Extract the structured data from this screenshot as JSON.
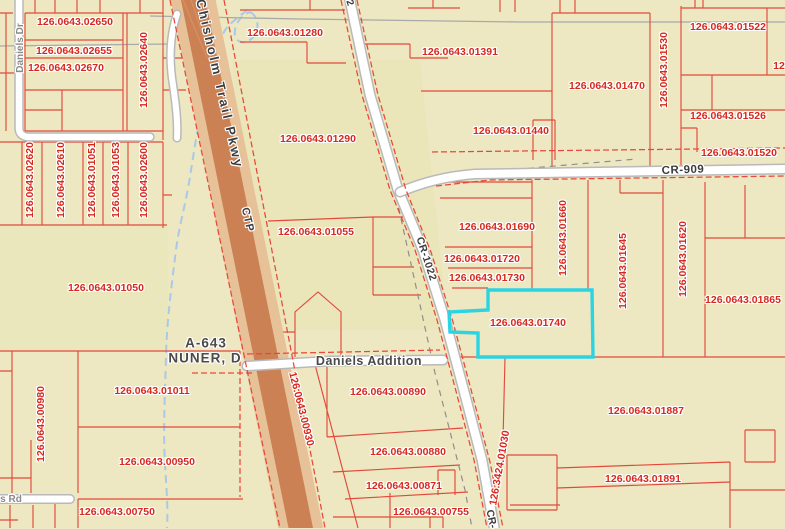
{
  "map": {
    "highlighted_parcel": "126.0643.01740",
    "colors": {
      "background": "#EDE8C1",
      "parcel_line": "#E24A3E",
      "parcel_text": "#D6281E",
      "highlight": "#2BD4E3",
      "highway_core": "#CB8154",
      "highway_edge": "#E7C299",
      "road_fill": "#FFFFFF",
      "road_casing": "#B9B9B9",
      "creek": "#A9C9E8",
      "gray_text": "#4A4A4A"
    },
    "labels": [
      {
        "t": "126.0643.02650",
        "c": "p",
        "x": 75,
        "y": 22
      },
      {
        "t": "126.0643.02655",
        "c": "p",
        "x": 74,
        "y": 51
      },
      {
        "t": "126.0643.02670",
        "c": "p",
        "x": 66,
        "y": 68
      },
      {
        "t": "126.0643.02640",
        "c": "p",
        "x": 144,
        "y": 70,
        "r": -90
      },
      {
        "t": "126.0643.02620",
        "c": "p",
        "x": 30,
        "y": 180,
        "r": -90
      },
      {
        "t": "126.0643.02610",
        "c": "p",
        "x": 61,
        "y": 180,
        "r": -90
      },
      {
        "t": "126.0643.01051",
        "c": "p",
        "x": 92,
        "y": 180,
        "r": -90
      },
      {
        "t": "126.0643.01053",
        "c": "p",
        "x": 116,
        "y": 180,
        "r": -90
      },
      {
        "t": "126.0643.02600",
        "c": "p",
        "x": 144,
        "y": 180,
        "r": -90
      },
      {
        "t": "126.0643.01050",
        "c": "p",
        "x": 106,
        "y": 288
      },
      {
        "t": "126.0643.01280",
        "c": "p",
        "x": 285,
        "y": 33
      },
      {
        "t": "126.0643.01290",
        "c": "p",
        "x": 318,
        "y": 139
      },
      {
        "t": "126.0643.01055",
        "c": "p",
        "x": 316,
        "y": 232
      },
      {
        "t": "126.0643.01391",
        "c": "p",
        "x": 460,
        "y": 52
      },
      {
        "t": "126.0643.01470",
        "c": "p",
        "x": 607,
        "y": 86
      },
      {
        "t": "126.0643.01530",
        "c": "p",
        "x": 664,
        "y": 70,
        "r": -90
      },
      {
        "t": "126.0643.01522",
        "c": "p",
        "x": 728,
        "y": 27
      },
      {
        "t": "12",
        "c": "p",
        "x": 779,
        "y": 66
      },
      {
        "t": "126.0643.01440",
        "c": "p",
        "x": 511,
        "y": 131
      },
      {
        "t": "126.0643.01526",
        "c": "p",
        "x": 728,
        "y": 116
      },
      {
        "t": "126.0643.01520",
        "c": "p",
        "x": 739,
        "y": 153
      },
      {
        "t": "126.0643.01690",
        "c": "p",
        "x": 497,
        "y": 227
      },
      {
        "t": "126.0643.01720",
        "c": "p",
        "x": 482,
        "y": 259
      },
      {
        "t": "126.0643.01730",
        "c": "p",
        "x": 487,
        "y": 278
      },
      {
        "t": "126.0643.01660",
        "c": "p",
        "x": 563,
        "y": 238,
        "r": -90
      },
      {
        "t": "126.0643.01645",
        "c": "p",
        "x": 623,
        "y": 271,
        "r": -90
      },
      {
        "t": "126.0643.01620",
        "c": "p",
        "x": 683,
        "y": 259,
        "r": -90
      },
      {
        "t": "126.0643.01865",
        "c": "p",
        "x": 743,
        "y": 300
      },
      {
        "t": "126.0643.01740",
        "c": "p",
        "x": 528,
        "y": 323,
        "n": "highlighted-parcel-label"
      },
      {
        "t": "126.0643.01011",
        "c": "p",
        "x": 152,
        "y": 391
      },
      {
        "t": "126.0643.00980",
        "c": "p",
        "x": 41,
        "y": 424,
        "r": -90
      },
      {
        "t": "126.0643.00950",
        "c": "p",
        "x": 157,
        "y": 462
      },
      {
        "t": "126.0643.00750",
        "c": "p",
        "x": 117,
        "y": 512
      },
      {
        "t": "126.0643.00890",
        "c": "p",
        "x": 388,
        "y": 392
      },
      {
        "t": "126.0643.00930",
        "c": "p",
        "x": 301,
        "y": 409,
        "r": 76
      },
      {
        "t": "126.0643.00880",
        "c": "p",
        "x": 408,
        "y": 452
      },
      {
        "t": "126.0643.00871",
        "c": "p",
        "x": 404,
        "y": 486
      },
      {
        "t": "126.0643.00755",
        "c": "p",
        "x": 431,
        "y": 512
      },
      {
        "t": "126.3424.01030",
        "c": "p",
        "x": 500,
        "y": 468,
        "r": -80
      },
      {
        "t": "126.0643.01887",
        "c": "p",
        "x": 646,
        "y": 411
      },
      {
        "t": "126.0643.01891",
        "c": "p",
        "x": 643,
        "y": 479
      },
      {
        "t": "Chisholm  Trail  Pkwy",
        "c": "r",
        "x": 220,
        "y": 84,
        "r": 77,
        "s": 13,
        "ls": 2.5,
        "n": "road-label-chisholm-trail-pkwy"
      },
      {
        "t": "CTP",
        "c": "r",
        "x": 247,
        "y": 220,
        "r": 77,
        "s": 11,
        "ls": 1,
        "n": "road-label-ctp"
      },
      {
        "t": "CR-1022",
        "c": "r",
        "x": 426,
        "y": 259,
        "r": 72,
        "s": 10.5,
        "ls": 0.5,
        "n": "road-label-cr-1022"
      },
      {
        "t": "CR-909",
        "c": "r",
        "x": 683,
        "y": 171,
        "r": -2,
        "s": 11.5,
        "ls": 0.5,
        "n": "road-label-cr-909"
      },
      {
        "t": "CR-",
        "c": "r",
        "x": 491,
        "y": 519,
        "r": 78,
        "s": 10.5,
        "n": "road-label-cr-1022-south"
      },
      {
        "t": "2",
        "c": "r",
        "x": 349,
        "y": 3,
        "r": 72,
        "s": 10,
        "n": "road-label-partial"
      },
      {
        "t": "Daniels Dr",
        "c": "r lt",
        "x": 21,
        "y": 48,
        "r": -90,
        "s": 10,
        "n": "road-label-daniels-dr"
      },
      {
        "t": "s Rd",
        "c": "r lt",
        "x": 11,
        "y": 500,
        "s": 10,
        "n": "road-label-s-rd"
      },
      {
        "t": "A-643",
        "c": "g",
        "x": 206,
        "y": 343,
        "s": 13.5,
        "ls": 1,
        "n": "abstract-label-a-643"
      },
      {
        "t": "NUNER, D",
        "c": "g",
        "x": 205,
        "y": 358,
        "s": 13.5,
        "ls": 1,
        "n": "abstract-label-nuner-d"
      },
      {
        "t": "Daniels Addition",
        "c": "g",
        "x": 369,
        "y": 361,
        "s": 12.5,
        "ls": 0.5,
        "n": "subdivision-label-daniels-addition"
      }
    ]
  }
}
